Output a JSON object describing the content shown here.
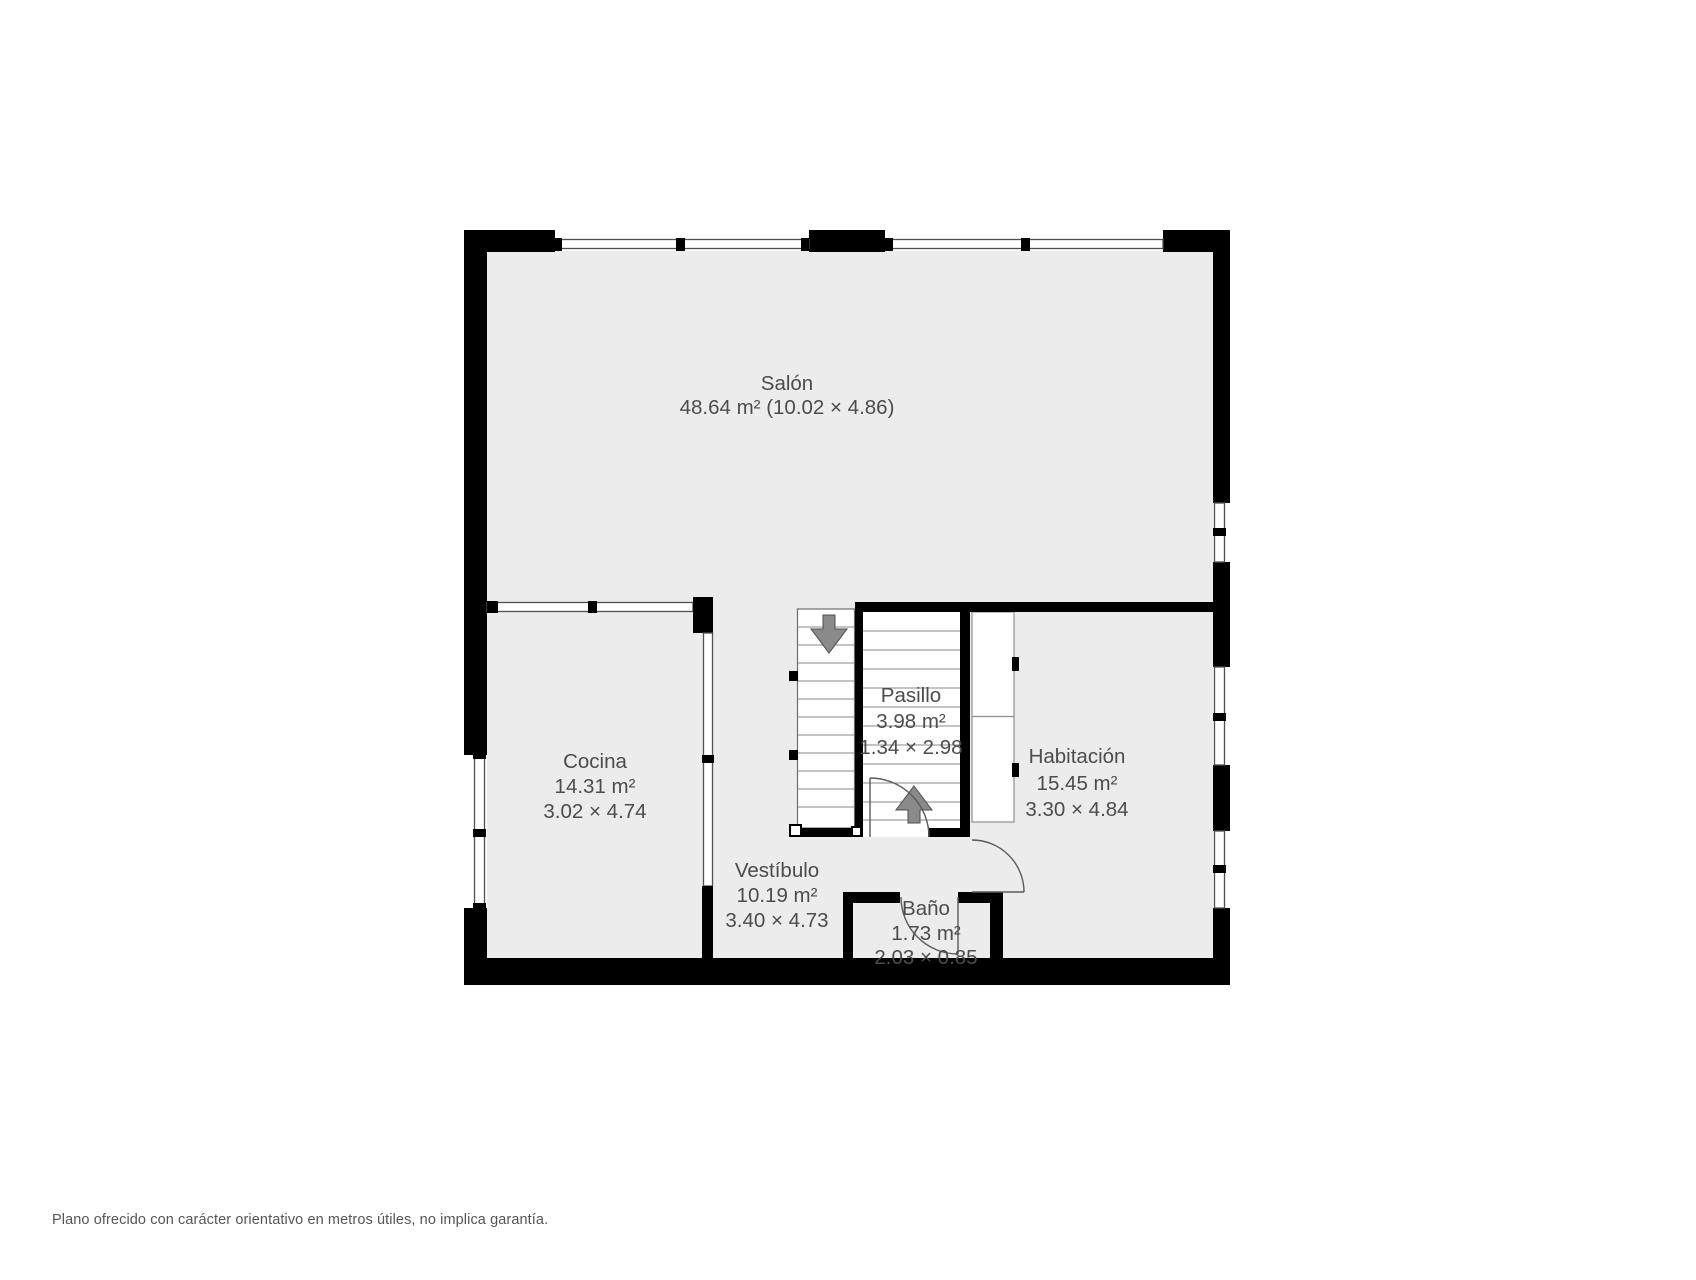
{
  "rooms": [
    {
      "name": "Salón",
      "detail": "48.64 m² (10.02 × 4.86)"
    },
    {
      "name": "Cocina",
      "area": "14.31 m²",
      "dims": "3.02 × 4.74"
    },
    {
      "name": "Pasillo",
      "area": "3.98 m²",
      "dims": "1.34 × 2.98"
    },
    {
      "name": "Vestíbulo",
      "area": "10.19 m²",
      "dims": "3.40 × 4.73"
    },
    {
      "name": "Baño",
      "area": "1.73 m²",
      "dims": "2.03 × 0.85"
    },
    {
      "name": "Habitación",
      "area": "15.45 m²",
      "dims": "3.30 × 4.84"
    }
  ],
  "icons": {
    "stairs_down": "arrow-down-icon",
    "stairs_up": "arrow-up-icon"
  },
  "footer": {
    "disclaimer": "Plano ofrecido con carácter orientativo en metros útiles, no implica garantía."
  },
  "colors": {
    "floor": "#ECECEC",
    "wall": "#000000",
    "label": "#4C4C4C",
    "arrow": "#8A8A8A"
  }
}
